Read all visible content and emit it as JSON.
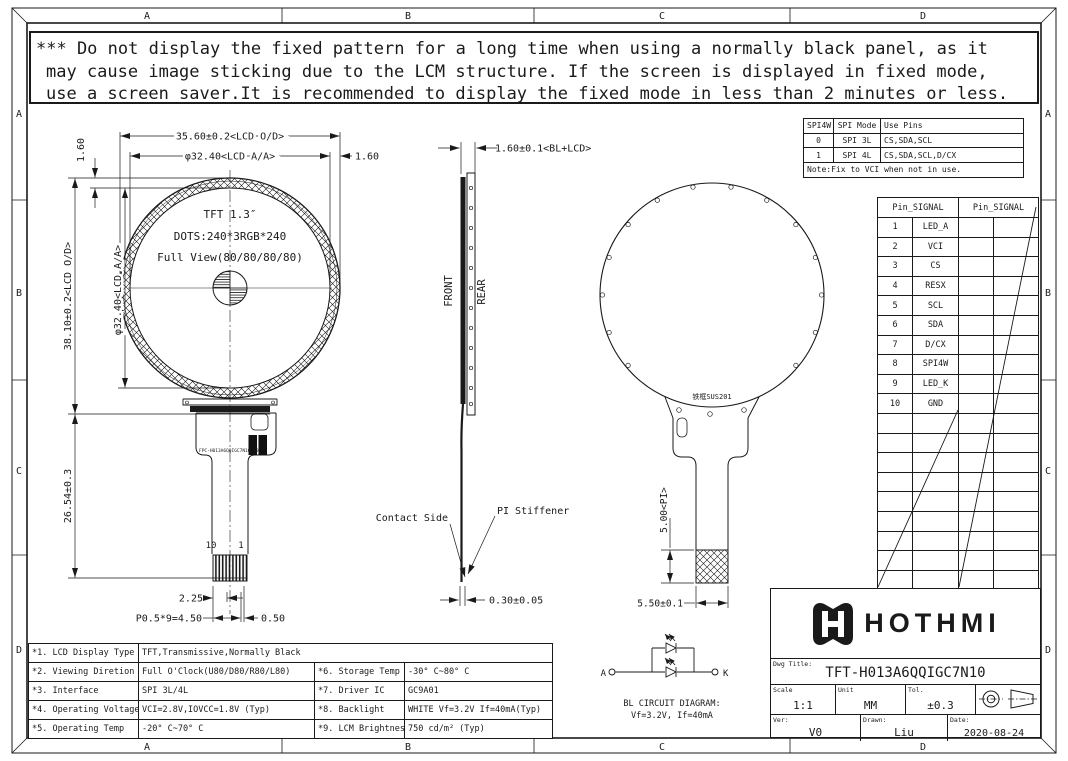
{
  "frame": {
    "zones": [
      "A",
      "B",
      "C",
      "D"
    ]
  },
  "warning": {
    "line1": "*** Do not display the fixed pattern for a long time when using a normally black panel, as it",
    "line2": "may cause image sticking due to the LCM structure. If the screen is displayed in fixed mode,",
    "line3": "use a screen saver.It is recommended to display the fixed mode in less than 2 minutes or less."
  },
  "front_view": {
    "line1": "TFT 1.3″",
    "line2": "DOTS:240*3RGB*240",
    "line3": "Full View(80/80/80/80)",
    "dim_od_w": "35.60±0.2<LCD O/D>",
    "dim_aa_w": "φ32.40<LCD A/A>",
    "dim_margin_right": "1.60",
    "dim_margin_top": "1.60",
    "dim_od_h": "38.10±0.2<LCD O/D>",
    "dim_aa_h": "φ32.40<LCD A/A>",
    "dim_fpc_len": "26.54±0.3",
    "pin_no_10": "10",
    "pin_no_1": "1",
    "dim_offset": "2.25",
    "dim_pitch": "P0.5*9=4.50",
    "dim_margin_bottom": "0.50",
    "fpc_code": "FPC-H013A6QQIGC7N10_V0"
  },
  "side_view": {
    "dim_thickness": "1.60±0.1<BL+LCD>",
    "front_label": "FRONT",
    "rear_label": "REAR",
    "contact_side": "Contact Side",
    "pi_stiffener": "PI Stiffener",
    "dim_fpc_thickness": "0.30±0.05"
  },
  "rear_view": {
    "frame_material": "铁框SUS201",
    "dim_pi": "5.00<PI>",
    "dim_tail_w": "5.50±0.1"
  },
  "bl_circuit": {
    "anode": "A",
    "cathode": "K",
    "title": "BL CIRCUIT DIAGRAM:",
    "spec": "Vf=3.2V, If=40mA"
  },
  "spi_table": {
    "h1": "SPI4W",
    "h2": "SPI Mode",
    "h3": "Use Pins",
    "r1c1": "0",
    "r1c2": "SPI 3L",
    "r1c3": "CS,SDA,SCL",
    "r2c1": "1",
    "r2c2": "SPI 4L",
    "r2c3": "CS,SDA,SCL,D/CX",
    "note": "Note:Fix to VCI when not in use."
  },
  "pin_table": {
    "header_left": "Pin_SIGNAL",
    "header_right": "Pin_SIGNAL",
    "pins": [
      {
        "no": "1",
        "signal": "LED_A"
      },
      {
        "no": "2",
        "signal": "VCI"
      },
      {
        "no": "3",
        "signal": "CS"
      },
      {
        "no": "4",
        "signal": "RESX"
      },
      {
        "no": "5",
        "signal": "SCL"
      },
      {
        "no": "6",
        "signal": "SDA"
      },
      {
        "no": "7",
        "signal": "D/CX"
      },
      {
        "no": "8",
        "signal": "SPI4W"
      },
      {
        "no": "9",
        "signal": "LED_K"
      },
      {
        "no": "10",
        "signal": "GND"
      }
    ]
  },
  "spec_table": {
    "rows": [
      {
        "l1": "*1. LCD Display Type",
        "v1": "TFT,Transmissive,Normally Black",
        "l2": "",
        "v2": ""
      },
      {
        "l1": "*2. Viewing Diretion",
        "v1": "Full O'Clock(U80/D80/R80/L80)",
        "l2": "*6. Storage Temp",
        "v2": "-30° C~80° C"
      },
      {
        "l1": "*3. Interface",
        "v1": "SPI 3L/4L",
        "l2": "*7. Driver IC",
        "v2": "GC9A01"
      },
      {
        "l1": "*4. Operating Voltage",
        "v1": "VCI=2.8V,IOVCC=1.8V (Typ)",
        "l2": "*8. Backlight",
        "v2": "WHITE Vf=3.2V If=40mA(Typ)"
      },
      {
        "l1": "*5. Operating Temp",
        "v1": "-20° C~70° C",
        "l2": "*9. LCM Brightness",
        "v2": "750 cd/m² (Typ)"
      }
    ]
  },
  "title_block": {
    "brand": "HOTHMI",
    "dwg_title_label": "Dwg Title:",
    "dwg_title": "TFT-H013A6QQIGC7N10",
    "scale_label": "Scale",
    "scale": "1:1",
    "unit_label": "Unit",
    "unit": "MM",
    "tol_label": "Tol.",
    "tol": "±0.3",
    "ver_label": "Ver:",
    "ver": "V0",
    "drawn_label": "Drawn:",
    "drawn": "Liu",
    "date_label": "Date:",
    "date": "2020-08-24"
  }
}
